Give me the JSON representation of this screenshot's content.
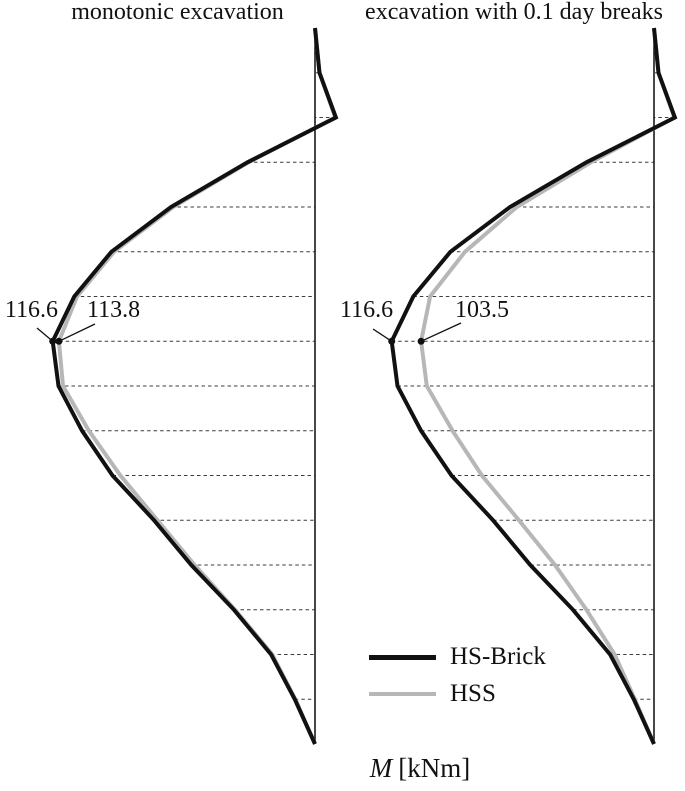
{
  "figure": {
    "legend": {
      "items": [
        {
          "label": "HS-Brick",
          "color": "#111111",
          "thickness": 5
        },
        {
          "label": "HSS",
          "color": "#b7b7b7",
          "thickness": 4
        }
      ]
    },
    "xlabel": {
      "m": "M",
      "units": "[kNm]"
    }
  },
  "chart_data": {
    "type": "line",
    "description": "Bending moment envelopes along a retaining wall (depth profiles); moment plotted horizontally from the wall axis, depth vertically. Dashed horizontal lines mark wall depth levels.",
    "x_axis_label": "M [kNm]",
    "units": "kNm",
    "depth_levels": 17,
    "legend_position": "bottom-center",
    "plots": [
      {
        "title": "monotonic excavation",
        "series": [
          {
            "name": "HS-Brick",
            "color": "#111111",
            "values": [
              0,
              -2,
              -9.3,
              30,
              64,
              90.5,
              107,
              116.6,
              114,
              103.5,
              90,
              71.5,
              55,
              36,
              19.5,
              9,
              0
            ]
          },
          {
            "name": "HSS",
            "color": "#b7b7b7",
            "values": [
              0,
              -2,
              -9,
              29.5,
              63,
              89.3,
              105.8,
              113.8,
              112,
              100.5,
              86.5,
              70,
              53.5,
              35.5,
              19,
              8.7,
              0
            ]
          }
        ],
        "annotations": [
          {
            "text": "116.6",
            "series": 0,
            "level": 7,
            "value": 116.6
          },
          {
            "text": "113.8",
            "series": 1,
            "level": 7,
            "value": 113.8
          }
        ]
      },
      {
        "title": "excavation with 0.1 day breaks",
        "series": [
          {
            "name": "HS-Brick",
            "color": "#111111",
            "values": [
              0,
              -2,
              -9.3,
              30,
              64,
              90.5,
              107,
              116.6,
              114,
              103.5,
              90,
              71.5,
              55,
              36,
              19.5,
              9,
              0
            ]
          },
          {
            "name": "HSS",
            "color": "#b7b7b7",
            "values": [
              0,
              -2,
              -9,
              28,
              61,
              84,
              99.5,
              103.5,
              101,
              89.5,
              76.5,
              60,
              44,
              30,
              17.5,
              8.5,
              0
            ]
          }
        ],
        "annotations": [
          {
            "text": "116.6",
            "series": 0,
            "level": 7,
            "value": 116.6
          },
          {
            "text": "103.5",
            "series": 1,
            "level": 7,
            "value": 103.5
          }
        ]
      }
    ]
  }
}
